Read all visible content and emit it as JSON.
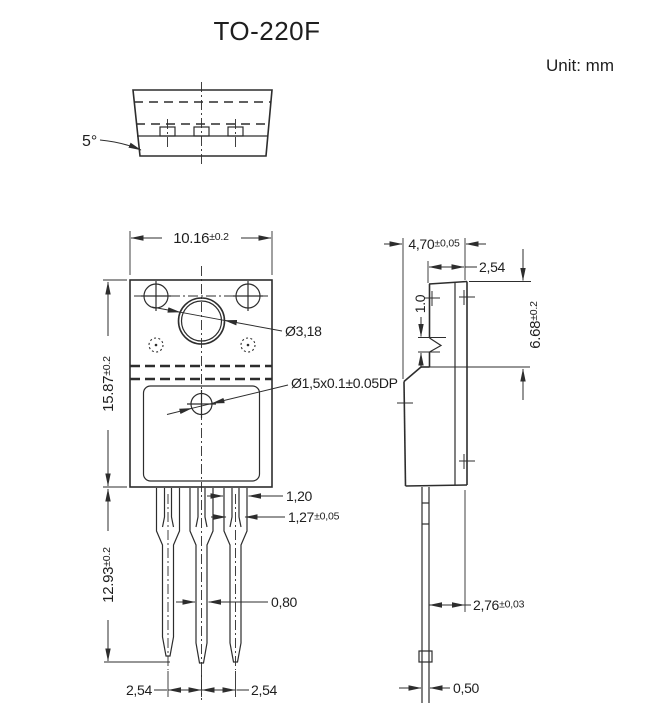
{
  "title": "TO-220F",
  "unit_label": "Unit: mm",
  "top_view": {
    "draft_angle": "5°"
  },
  "front_view": {
    "body_width": {
      "value": "10.16",
      "tol": "±0.2"
    },
    "body_height": {
      "value": "15.87",
      "tol": "±0.2"
    },
    "lead_length": {
      "value": "12.93",
      "tol": "±0.2"
    },
    "mounting_hole_diameter": "Ø3,18",
    "dimple_diameter": "Ø1,5x0.1±0.05DP",
    "lead_shoulder_width": "1,20",
    "lead_base_width": {
      "value": "1,27",
      "tol": "±0,05"
    },
    "lead_width": "0,80",
    "lead_pitch_left": "2,54",
    "lead_pitch_right": "2,54"
  },
  "side_view": {
    "body_thickness": {
      "value": "4,70",
      "tol": "±0,05"
    },
    "tab_thickness": "2,54",
    "dimple_height": "1.0",
    "tab_height": {
      "value": "6.68",
      "tol": "±0.2"
    },
    "lead_setback": {
      "value": "2,76",
      "tol": "±0,03"
    },
    "lead_thickness": "0,50"
  },
  "colors": {
    "line": "#2d2d2d",
    "text": "#1e1e1e",
    "background": "#ffffff"
  }
}
